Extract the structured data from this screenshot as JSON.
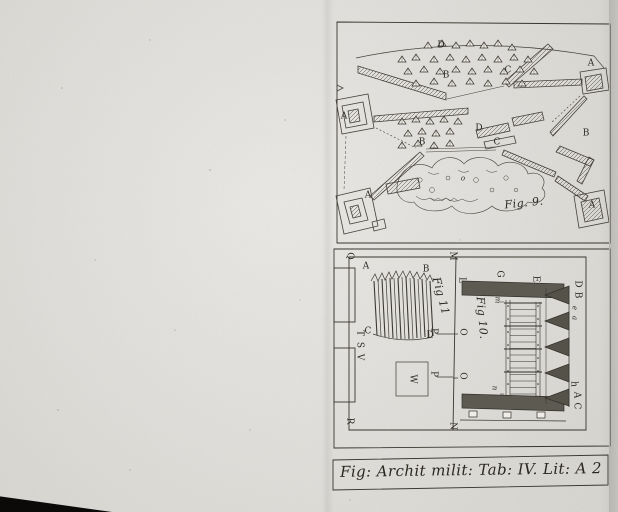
{
  "colors": {
    "paper": "#e9e7e2",
    "ink": "#3a362f",
    "shade_fill": "#57544b",
    "caption_ink": "#2b2820"
  },
  "plate": {
    "caption": "Fig: Archit milit: Tab: IV. Lit: A 2",
    "fig9": {
      "title": "Fig. 9.",
      "labels": {
        "d_camp_top": "D",
        "b_camp_top": "B",
        "c_upper_right": "C",
        "a_redoubt_right": "A",
        "a_redoubt_left": "A",
        "b_wall_mid": "B",
        "d_camp_mid": "D",
        "c_wall_mid": "C",
        "b_right": "B",
        "a_redoubt_bottom_left": "A",
        "a_redoubt_bottom_right": "A",
        "o_mound": "o"
      }
    },
    "fig11": {
      "title": "Fig 11",
      "labels": {
        "q": "Q",
        "m": "M",
        "r": "R",
        "n": "N",
        "a": "A",
        "b": "B",
        "c": "C",
        "d": "D",
        "w": "W",
        "t": "T",
        "s": "S",
        "v": "V",
        "p_upper": "P",
        "p_lower": "P",
        "o_upper": "O",
        "o_lower": "O"
      }
    },
    "fig10": {
      "title": "Fig 10.",
      "labels": {
        "l_top": "L",
        "g_top": "G",
        "e_top": "E",
        "d_right": "D",
        "b_right": "B",
        "e_small": "e",
        "a_small": "a",
        "h_right": "h",
        "a_right": "A",
        "c_right": "C",
        "m_mid": "m",
        "n_mid": "n"
      }
    }
  }
}
